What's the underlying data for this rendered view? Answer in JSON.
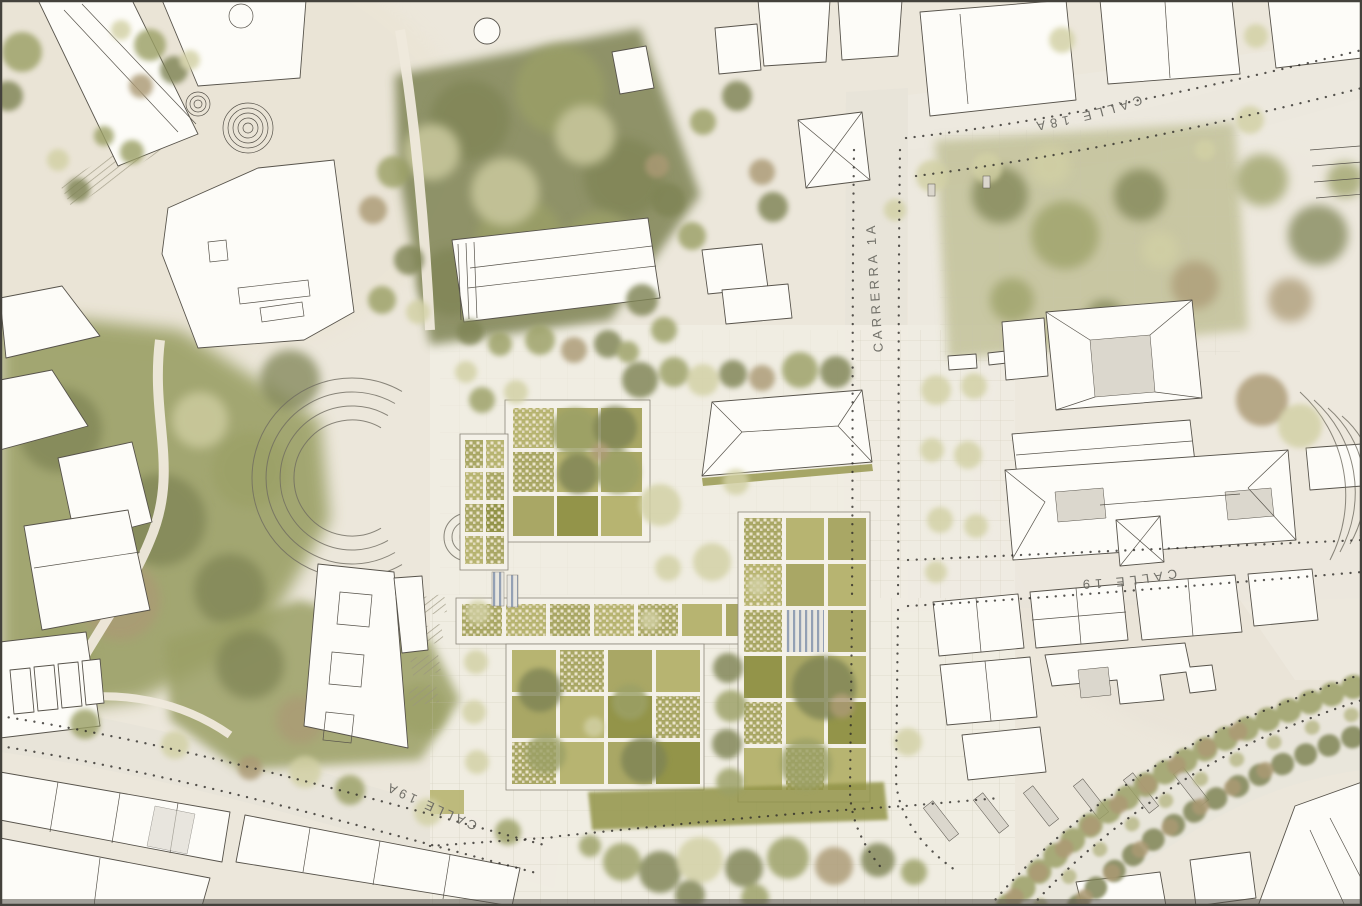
{
  "map": {
    "street_labels": {
      "calle_18a": "CALLE 18A",
      "carrera_1a": "CARRERRA 1A",
      "calle_19": "CALLE 19",
      "calle_19a": "CALLE 19A"
    }
  },
  "palette": {
    "paper": "#ece7db",
    "street": "#e7e3d8",
    "plaza": "#f1ede3",
    "bfill": "#fdfcf8",
    "bline": "#57534b",
    "roofshade": "#dbd7cd",
    "green_dark": "#7f8455",
    "green_mid": "#9ba066",
    "green_light": "#b8b88a",
    "green_pale": "#d2d0a4",
    "autumn": "#ab9a74",
    "cell_mid": "#a9a765",
    "cell_light": "#b7b471",
    "cell_dark": "#939449",
    "mosaic": "#ece5ca",
    "mosaic2": "#e0d9bd",
    "dots": "#2e2c28",
    "label": "#6b6a63",
    "border": "#44423c"
  }
}
